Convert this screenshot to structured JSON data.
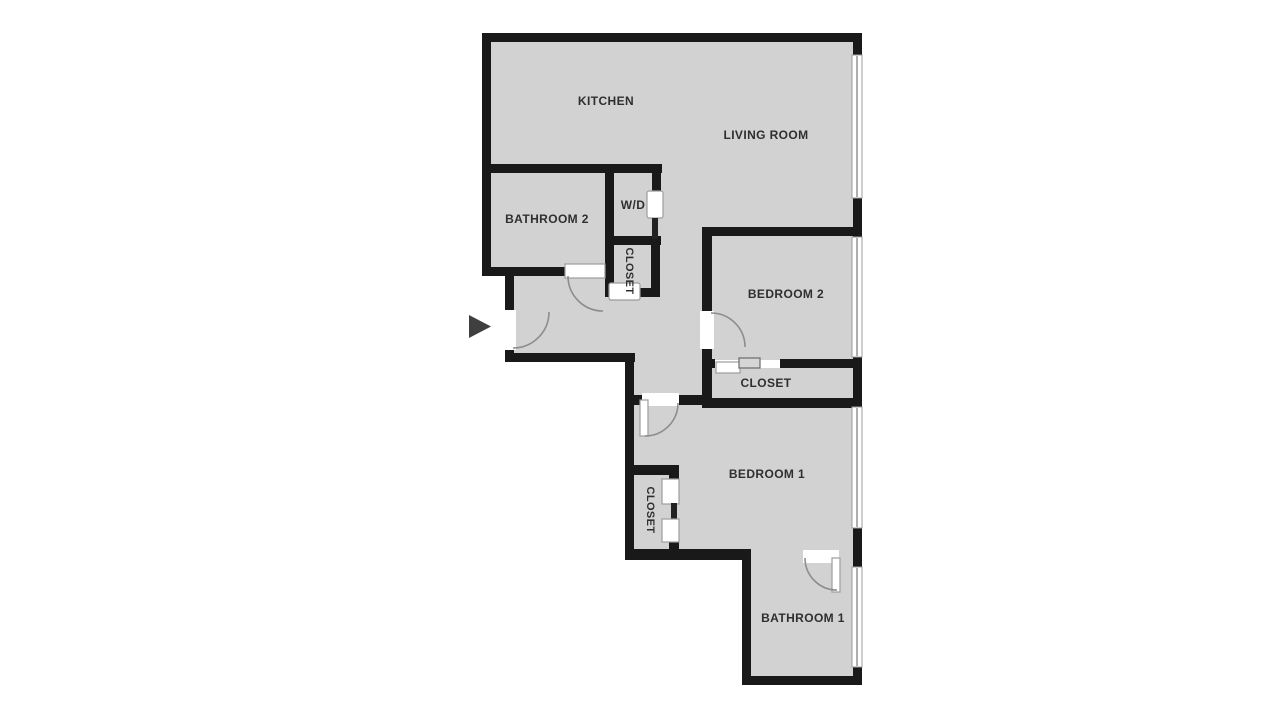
{
  "title": "Apartment floor plan",
  "rooms": {
    "kitchen": {
      "label": "KITCHEN"
    },
    "living_room": {
      "label": "LIVING ROOM"
    },
    "bathroom_2": {
      "label": "BATHROOM 2"
    },
    "washer_dryer": {
      "label": "W/D"
    },
    "hall_closet": {
      "label": "CLOSET"
    },
    "bedroom_2": {
      "label": "BEDROOM 2"
    },
    "bedroom_2_closet": {
      "label": "CLOSET"
    },
    "bedroom_1": {
      "label": "BEDROOM 1"
    },
    "bedroom_1_closet": {
      "label": "CLOSET"
    },
    "bathroom_1": {
      "label": "BATHROOM 1"
    }
  },
  "entry": {
    "icon": "entry-arrow",
    "direction": "right"
  },
  "counts": {
    "windows": 4,
    "swing_doors": 5,
    "sliding_doors": 4
  },
  "colors": {
    "background": "#ffffff",
    "floor": "#d2d2d2",
    "wall": "#191919",
    "door_arc": "#8d8d8d",
    "entry_arrow": "#3f3f3f",
    "label_text": "#2f2f2f"
  }
}
